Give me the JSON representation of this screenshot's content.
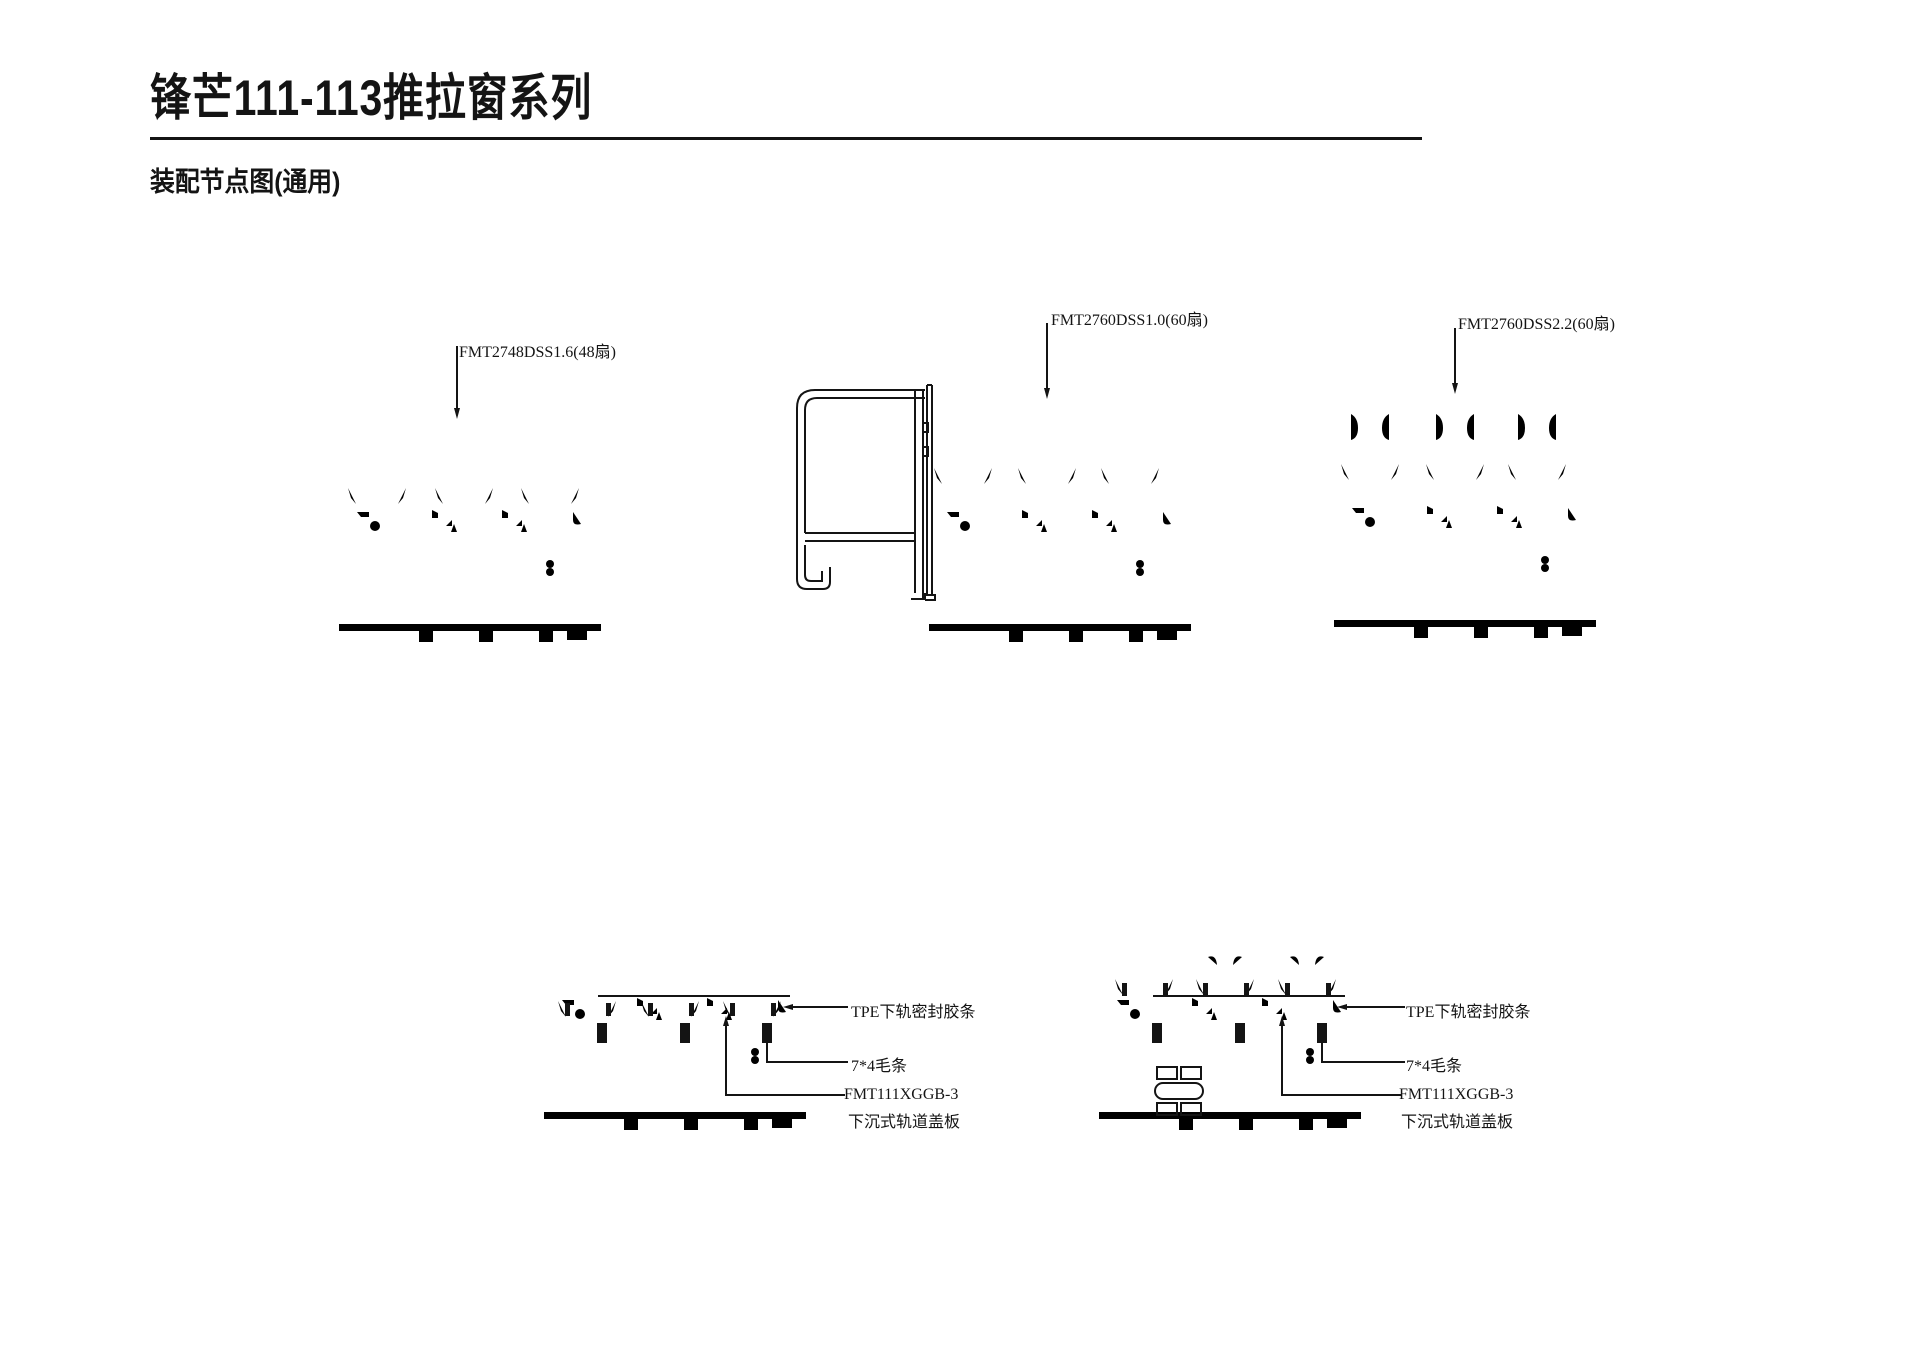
{
  "page": {
    "title": "锋芒111-113推拉窗系列",
    "subtitle": "装配节点图(通用)"
  },
  "colors": {
    "line": "#141414",
    "background": "#ffffff"
  },
  "top_row": {
    "d1_label": "FMT2748DSS1.6(48扇)",
    "d2_label": "FMT2760DSS1.0(60扇)",
    "d3_label": "FMT2760DSS2.2(60扇)"
  },
  "bottom_left": {
    "tpe": "TPE下轨密封胶条",
    "brush": "7*4毛条",
    "cover_line1": "FMT111XGGB-3",
    "cover_line2": "下沉式轨道盖板"
  },
  "bottom_right": {
    "tpe": "TPE下轨密封胶条",
    "brush": "7*4毛条",
    "cover_line1": "FMT111XGGB-3",
    "cover_line2": "下沉式轨道盖板"
  }
}
